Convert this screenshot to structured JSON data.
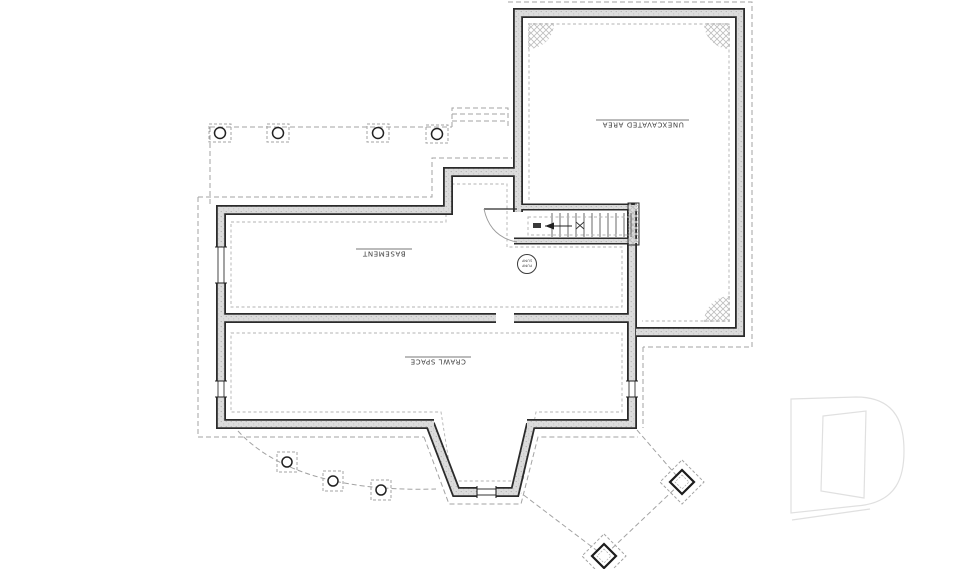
{
  "plan": {
    "rooms": [
      {
        "id": "unexcavated",
        "label": "UNEXCAVATED AREA"
      },
      {
        "id": "basement",
        "label": "BASEMENT"
      },
      {
        "id": "crawl-space",
        "label": "CRAWL SPACE"
      }
    ],
    "sump": {
      "line1": "SUMP",
      "line2": "PUMP"
    }
  },
  "colors": {
    "background": "#ffffff",
    "wall_line": "#2b2b2b",
    "wall_fill": "#d9d9d9",
    "dashed_line": "#a3a3a3",
    "hatch": "#bdbdbd",
    "label_text": "#3d3d3d",
    "watermark": "#e0e0e0"
  }
}
